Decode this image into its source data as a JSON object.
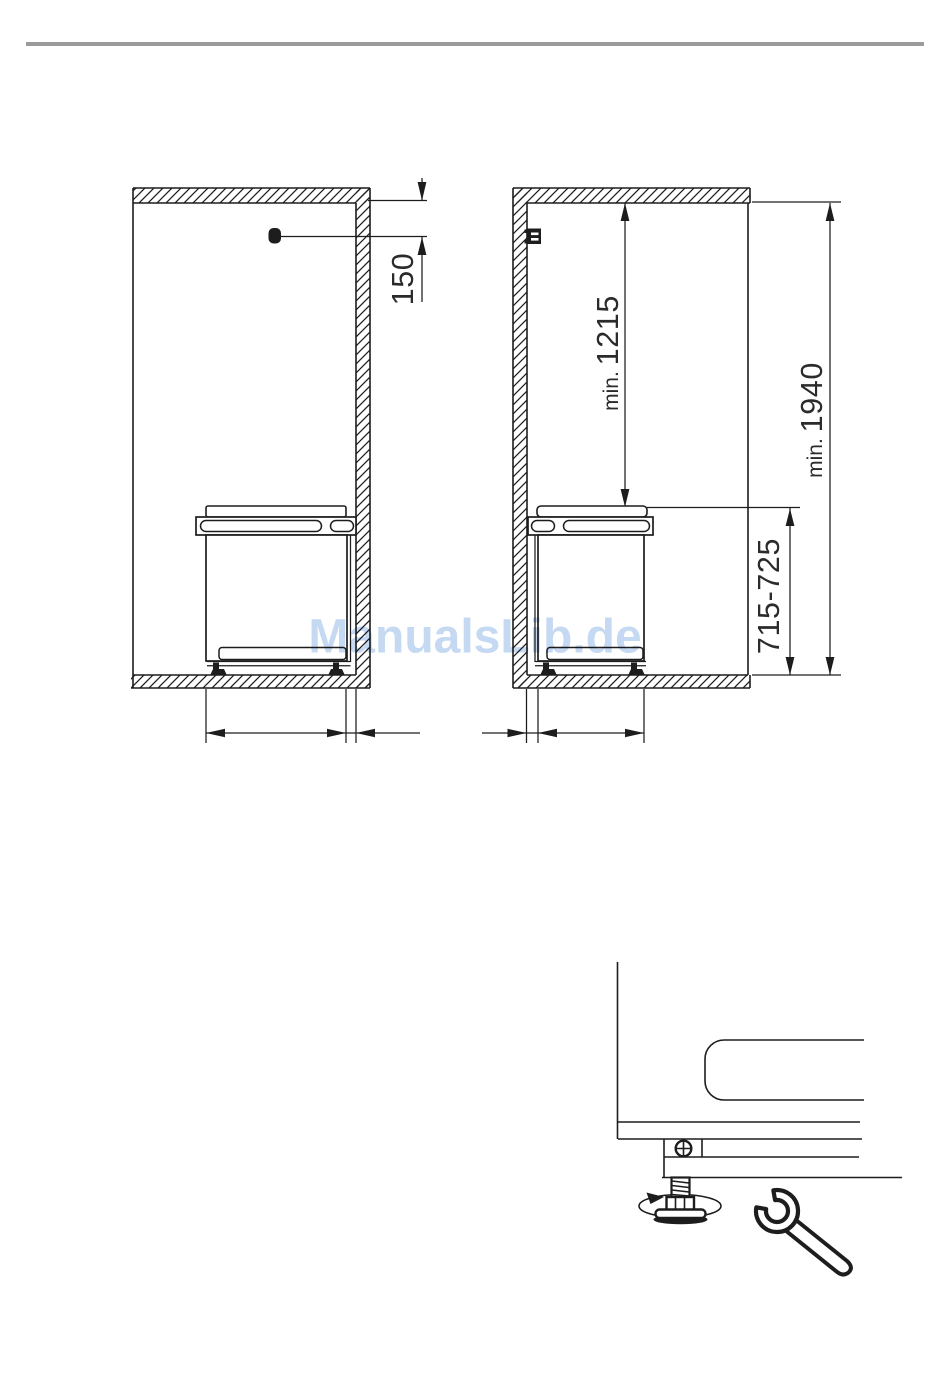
{
  "page": {
    "width": 950,
    "height": 1383,
    "background": "#ffffff",
    "divider_color": "#9b9b9b",
    "line_color": "#1d1d1d",
    "dim_text_color": "#2b2b2b"
  },
  "watermark": {
    "text": "ManualsLib.de",
    "color": "#c6d9f2"
  },
  "left_diagram": {
    "dim_sensor_to_ceiling": {
      "prefix": "",
      "value": "150"
    }
  },
  "right_diagram": {
    "dim_ceiling_to_appliance": {
      "prefix": "min. ",
      "value": "1215"
    },
    "dim_total_niche_height": {
      "prefix": "min. ",
      "value": "1940"
    },
    "dim_appliance_height": {
      "prefix": "",
      "value": "715-725"
    }
  },
  "icons": {
    "sensor": "filled-dot",
    "power_socket": "black-square-with-slots",
    "rotation_arrow": "ellipse-with-arrowhead",
    "adjustable_foot": "threaded-leveling-foot",
    "screw": "circle-with-cross",
    "wrench": "open-end-wrench"
  }
}
